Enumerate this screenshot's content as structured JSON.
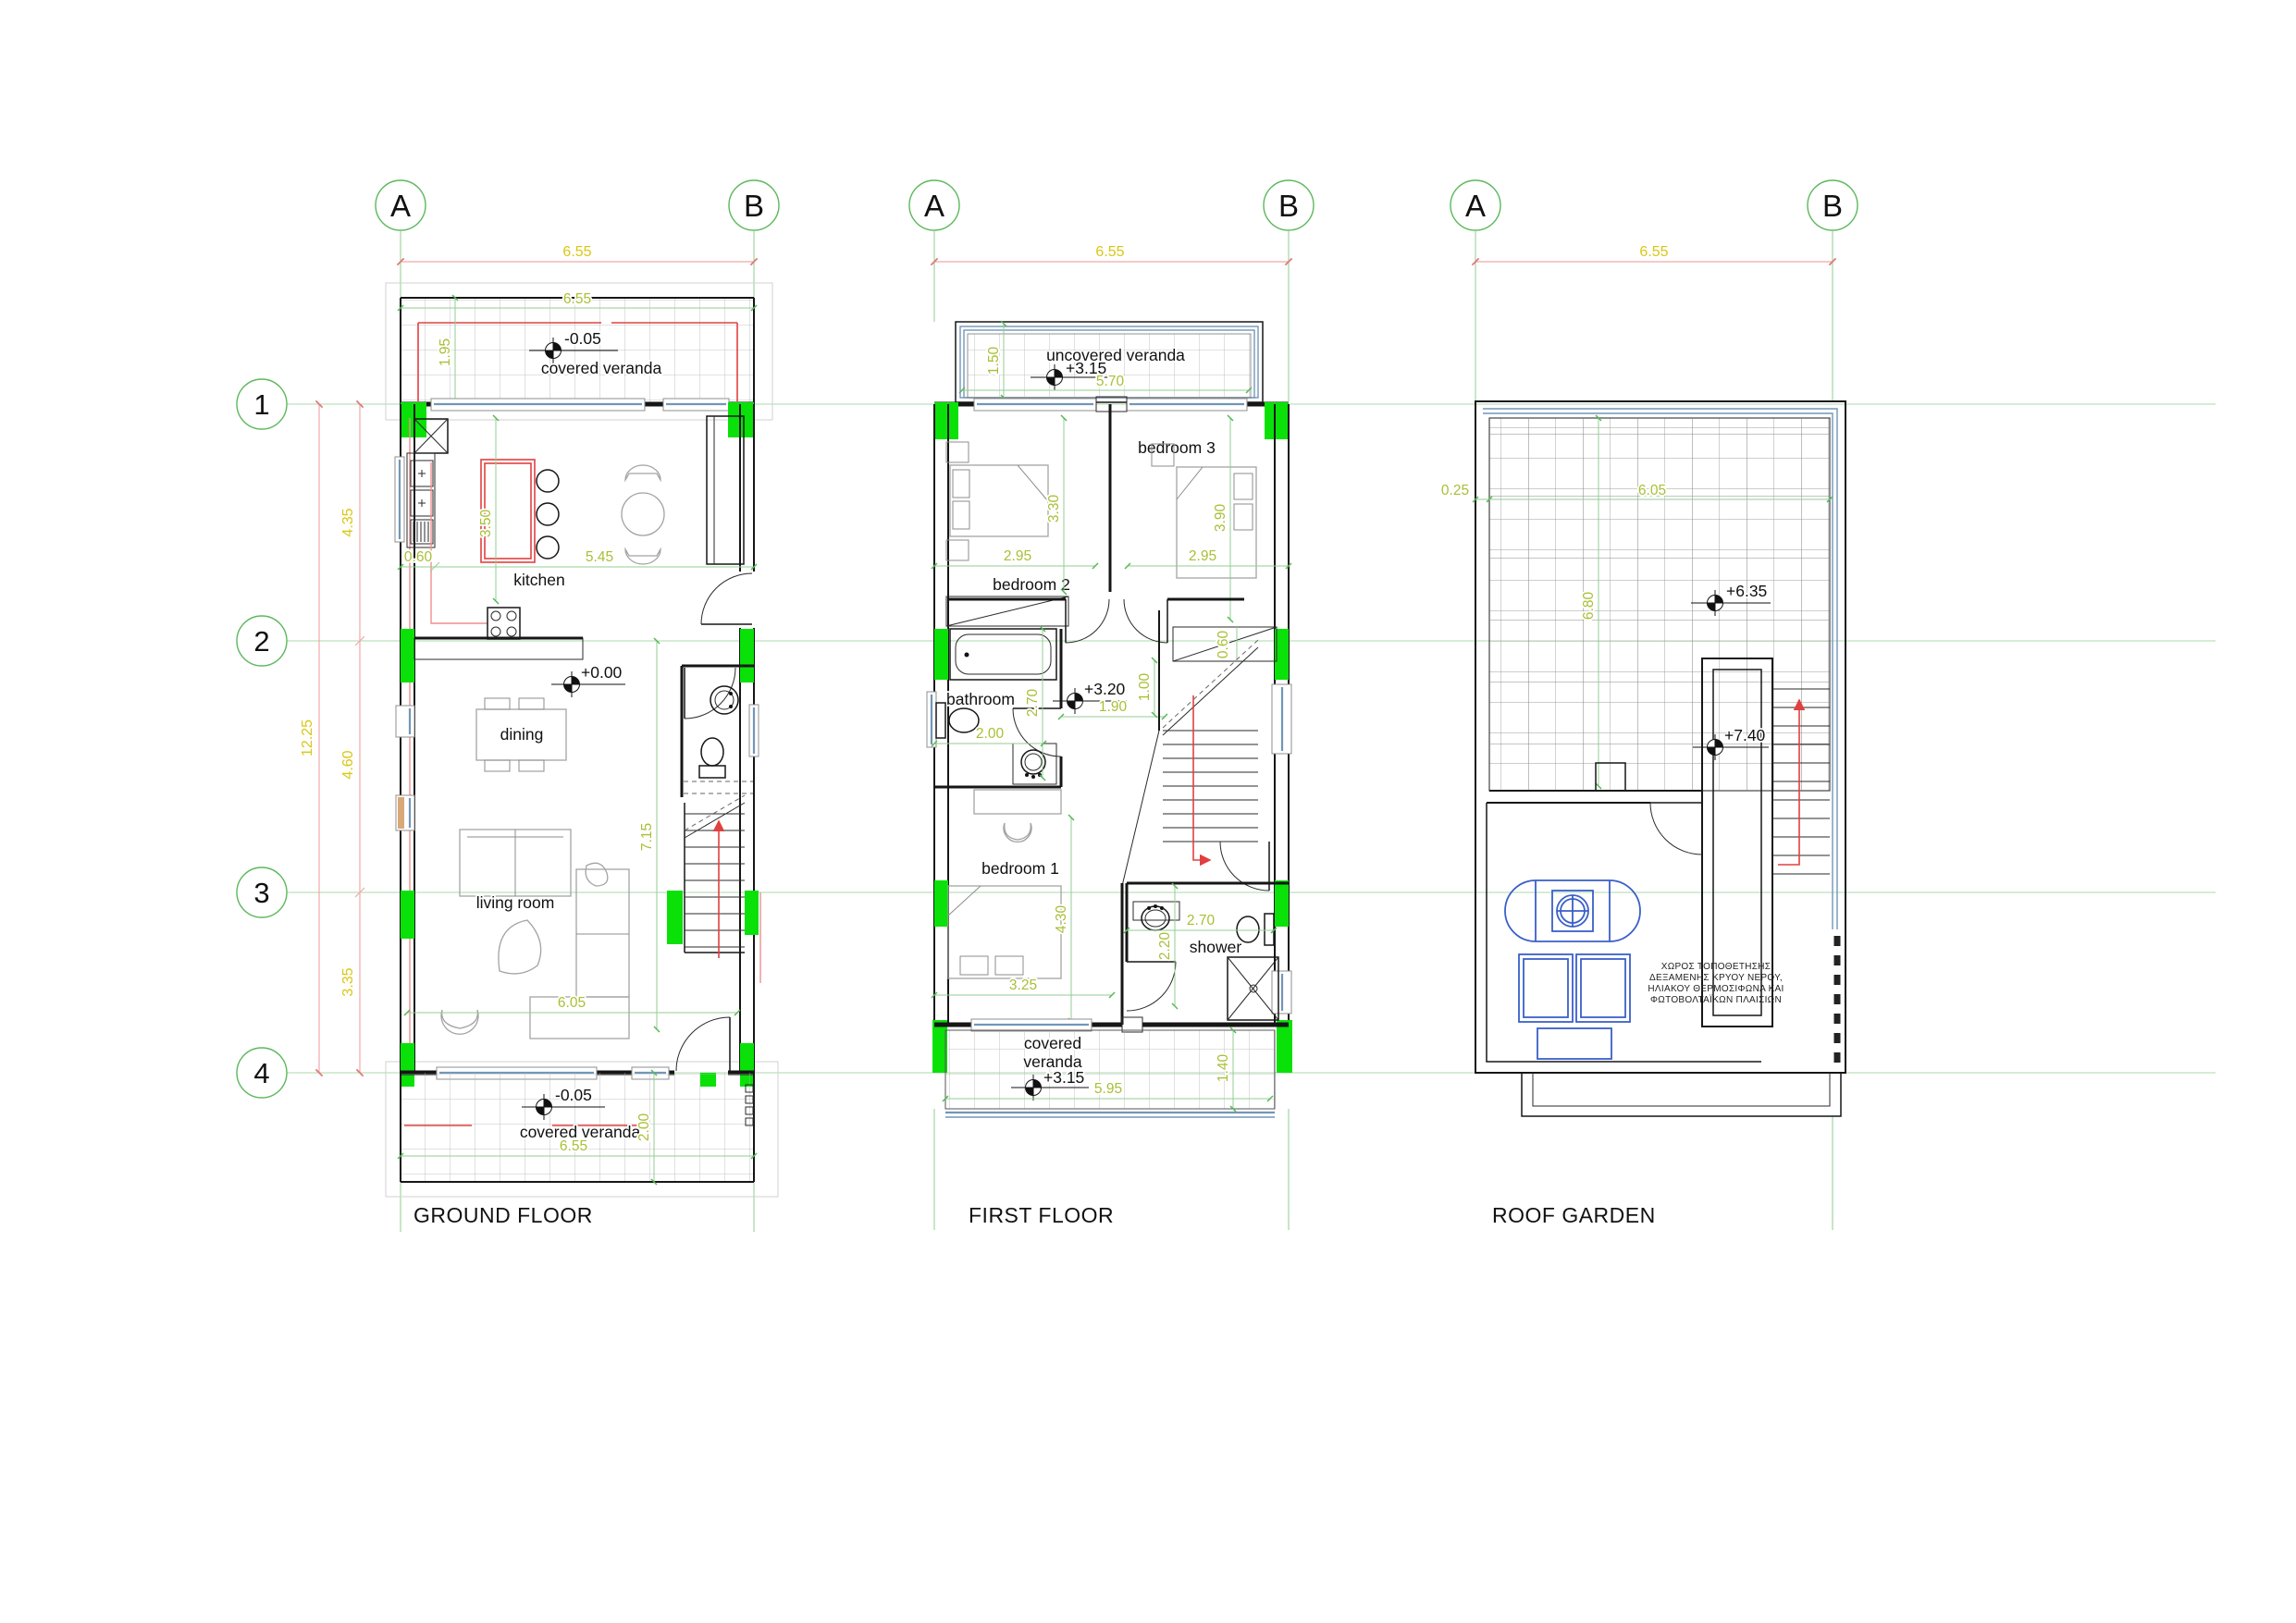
{
  "grid": {
    "columns": [
      "A",
      "B"
    ],
    "rows": [
      "1",
      "2",
      "3",
      "4"
    ]
  },
  "ground": {
    "title": "GROUND FLOOR",
    "rooms": {
      "veranda_top": "covered veranda",
      "kitchen": "kitchen",
      "dining": "dining",
      "living": "living room",
      "veranda_bottom": "covered veranda"
    },
    "levels": {
      "veranda_top": "-0.05",
      "main": "+0.00",
      "veranda_bottom": "-0.05"
    },
    "dims": {
      "overall": "6.55",
      "veranda_width": "6.55",
      "veranda_depth": "1.95",
      "kitchen_depth": "3.50",
      "kitchen_offset": "0.60",
      "kitchen_width": "5.45",
      "span_12": "4.35",
      "span_23": "4.60",
      "span_34": "3.35",
      "total_depth": "12.25",
      "stair_zone": "7.15",
      "living_width": "6.05",
      "veranda_bottom_depth": "2.00",
      "veranda_bottom_width": "6.55"
    }
  },
  "first": {
    "title": "FIRST FLOOR",
    "rooms": {
      "veranda_top": "uncovered veranda",
      "bedroom3": "bedroom 3",
      "bedroom2": "bedroom 2",
      "bathroom": "bathroom",
      "bedroom1": "bedroom 1",
      "shower": "shower",
      "veranda_bottom_line1": "covered",
      "veranda_bottom_line2": "veranda"
    },
    "levels": {
      "veranda_top": "+3.15",
      "hall": "+3.20",
      "veranda_bottom": "+3.15"
    },
    "dims": {
      "overall": "6.55",
      "veranda_depth": "1.50",
      "veranda_width": "5.70",
      "bedroom2_width": "2.95",
      "bedroom3_width": "2.95",
      "bedroom2_depth": "3.30",
      "bedroom3_depth": "3.90",
      "bathroom_depth": "2.70",
      "bathroom_width": "2.00",
      "hall_width": "1.90",
      "hall_depth": "1.00",
      "closet_depth": "0.60",
      "bedroom1_depth": "4.30",
      "bedroom1_width": "3.25",
      "shower_width": "2.70",
      "shower_depth": "2.20",
      "veranda_bottom_width": "5.95",
      "veranda_bottom_depth": "1.40"
    }
  },
  "roof": {
    "title": "ROOF GARDEN",
    "levels": {
      "terrace": "+6.35",
      "stairhead": "+7.40"
    },
    "dims": {
      "overall": "6.55",
      "parapet": "0.25",
      "terrace_width": "6.05",
      "terrace_depth": "6.80"
    },
    "note": [
      "ΧΩΡΟΣ ΤΟΠΟΘΕΤΗΣΗΣ",
      "ΔΕΞΑΜΕΝΗΣ ΚΡΥΟΥ ΝΕΡΟΥ,",
      "ΗΛΙΑΚΟΥ ΘΕΡΜΟΣΙΦΩΝΑ ΚΑΙ",
      "ΦΩΤΟΒΟΛΤΑΪΚΩΝ ΠΛΑΙΣΙΩΝ"
    ]
  },
  "colors": {
    "grid_green": "#5cb85c",
    "dim_green_line": "#93ce93",
    "dim_text_inner": "#a9bf35",
    "dim_text_outer": "#d9c714",
    "dim_line_outer": "#efa9a9",
    "column_fill": "#09e109",
    "accent_red": "#e14040",
    "glass_blue": "#7296b8",
    "equipment_blue": "#3a5fc8",
    "wall": "#161616"
  }
}
